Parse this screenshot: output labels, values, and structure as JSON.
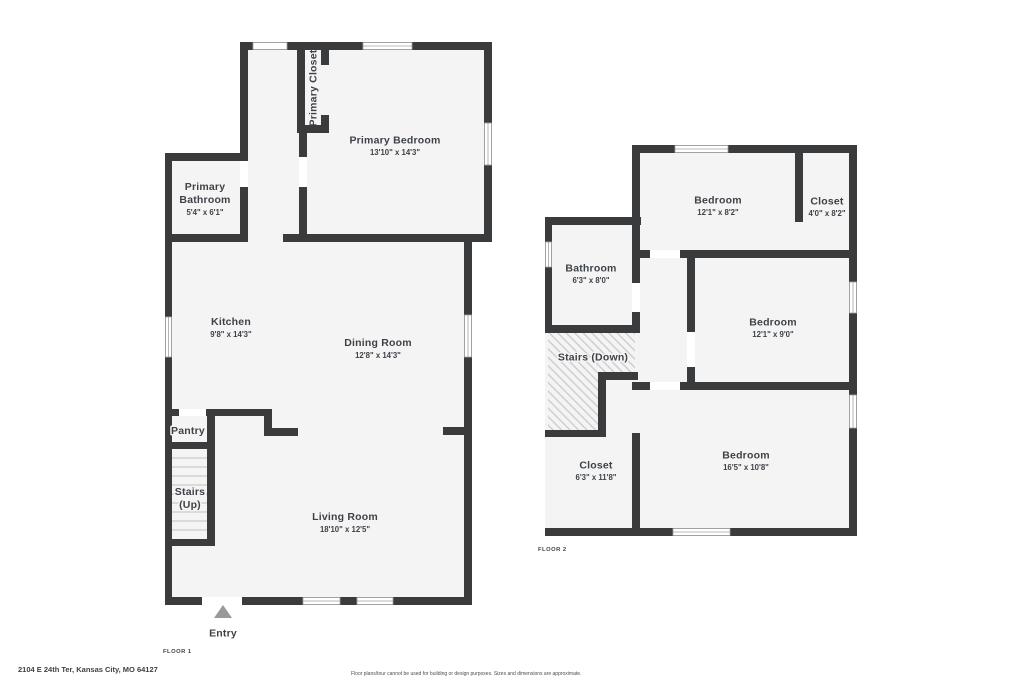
{
  "footer": {
    "address": "2104 E 24th Ter, Kansas City, MO 64127",
    "disclaimer": "Floor plans/tour cannot be used for building or design purposes. Sizes and dimensions are approximate."
  },
  "colors": {
    "wall": "#3a3b3d",
    "room_fill": "#f4f4f5",
    "text": "#3e4247",
    "window_line": "#a3a3a3",
    "stair_line": "#c9c9c9",
    "entry_arrow": "#97999c"
  },
  "floor1": {
    "label": "FLOOR 1",
    "entry_label": "Entry",
    "rooms": {
      "primary_closet": {
        "name": "Primary Closet"
      },
      "primary_bedroom": {
        "name": "Primary Bedroom",
        "dims": "13'10\" x 14'3\""
      },
      "primary_bathroom": {
        "name_line1": "Primary",
        "name_line2": "Bathroom",
        "dims": "5'4\" x 6'1\""
      },
      "kitchen": {
        "name": "Kitchen",
        "dims": "9'8\" x 14'3\""
      },
      "dining_room": {
        "name": "Dining Room",
        "dims": "12'8\" x 14'3\""
      },
      "pantry": {
        "name": "Pantry"
      },
      "stairs": {
        "name_line1": "Stairs",
        "name_line2": "(Up)"
      },
      "living_room": {
        "name": "Living Room",
        "dims": "18'10\" x 12'5\""
      }
    }
  },
  "floor2": {
    "label": "FLOOR 2",
    "rooms": {
      "bedroom_top": {
        "name": "Bedroom",
        "dims": "12'1\" x 8'2\""
      },
      "closet_top": {
        "name": "Closet",
        "dims": "4'0\" x 8'2\""
      },
      "bathroom": {
        "name": "Bathroom",
        "dims": "6'3\" x 8'0\""
      },
      "stairs": {
        "name": "Stairs (Down)"
      },
      "bedroom_middle": {
        "name": "Bedroom",
        "dims": "12'1\" x 9'0\""
      },
      "closet_bottom": {
        "name": "Closet",
        "dims": "6'3\" x 11'8\""
      },
      "bedroom_bottom": {
        "name": "Bedroom",
        "dims": "16'5\" x 10'8\""
      }
    }
  }
}
